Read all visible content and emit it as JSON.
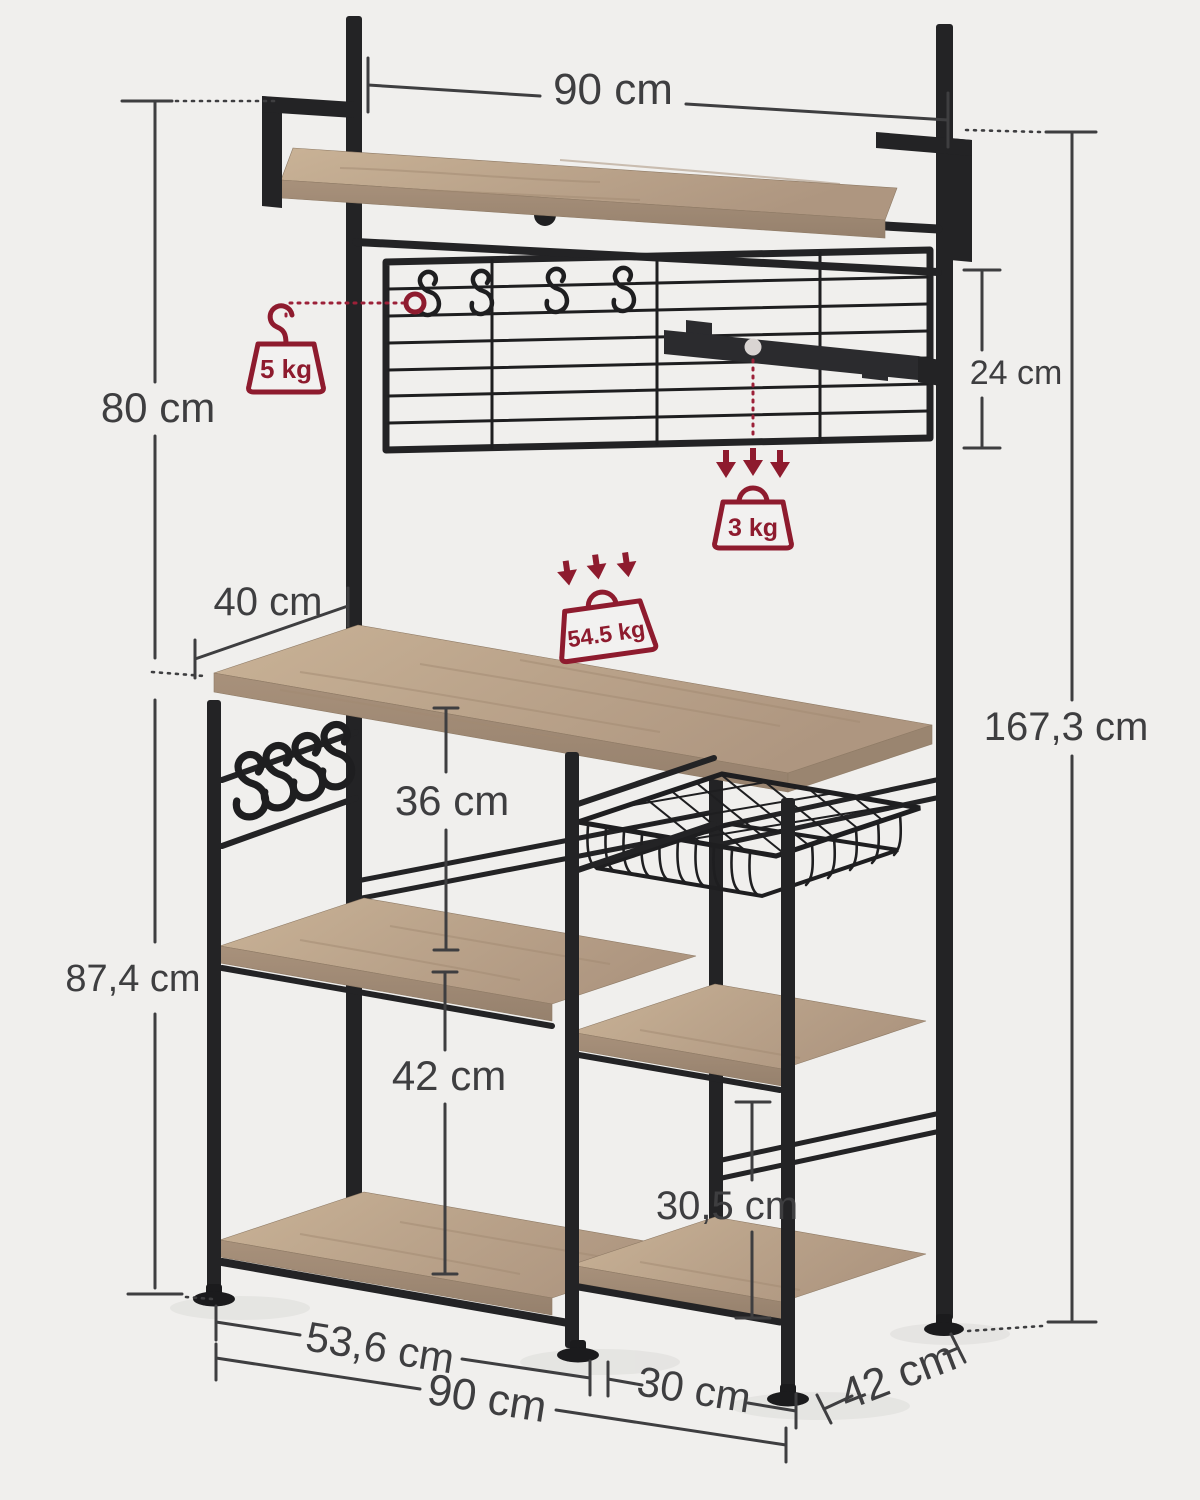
{
  "diagram": {
    "name": "Baker's rack dimension diagram",
    "dimensions": {
      "top_width": "90 cm",
      "hutch_height": "80 cm",
      "grid_height": "24 cm",
      "worktop_depth": "40 cm",
      "worktop_shelf_gap": "36 cm",
      "left_base_height": "87,4 cm",
      "total_height": "167,3 cm",
      "shelf_bottom_gap": "42 cm",
      "right_shelf_gap": "30,5 cm",
      "left_section_width": "53,6 cm",
      "base_width": "90 cm",
      "right_section_width": "30 cm",
      "base_depth": "42 cm"
    },
    "loads": {
      "hook": "5 kg",
      "rail": "3 kg",
      "worktop": "54.5 kg"
    },
    "colors": {
      "background": "#F0EFED",
      "metal": "#232325",
      "wood": "#BCA58C",
      "dimension_text": "#3E3E40",
      "accent_red": "#8E1B2E"
    },
    "icons": {
      "hook_weight": "hanging-weight-icon",
      "rail_weight": "weight-icon",
      "worktop_weight": "weight-icon",
      "load_arrows": "down-arrows-icon",
      "s_hooks": "s-hook-icon"
    }
  }
}
